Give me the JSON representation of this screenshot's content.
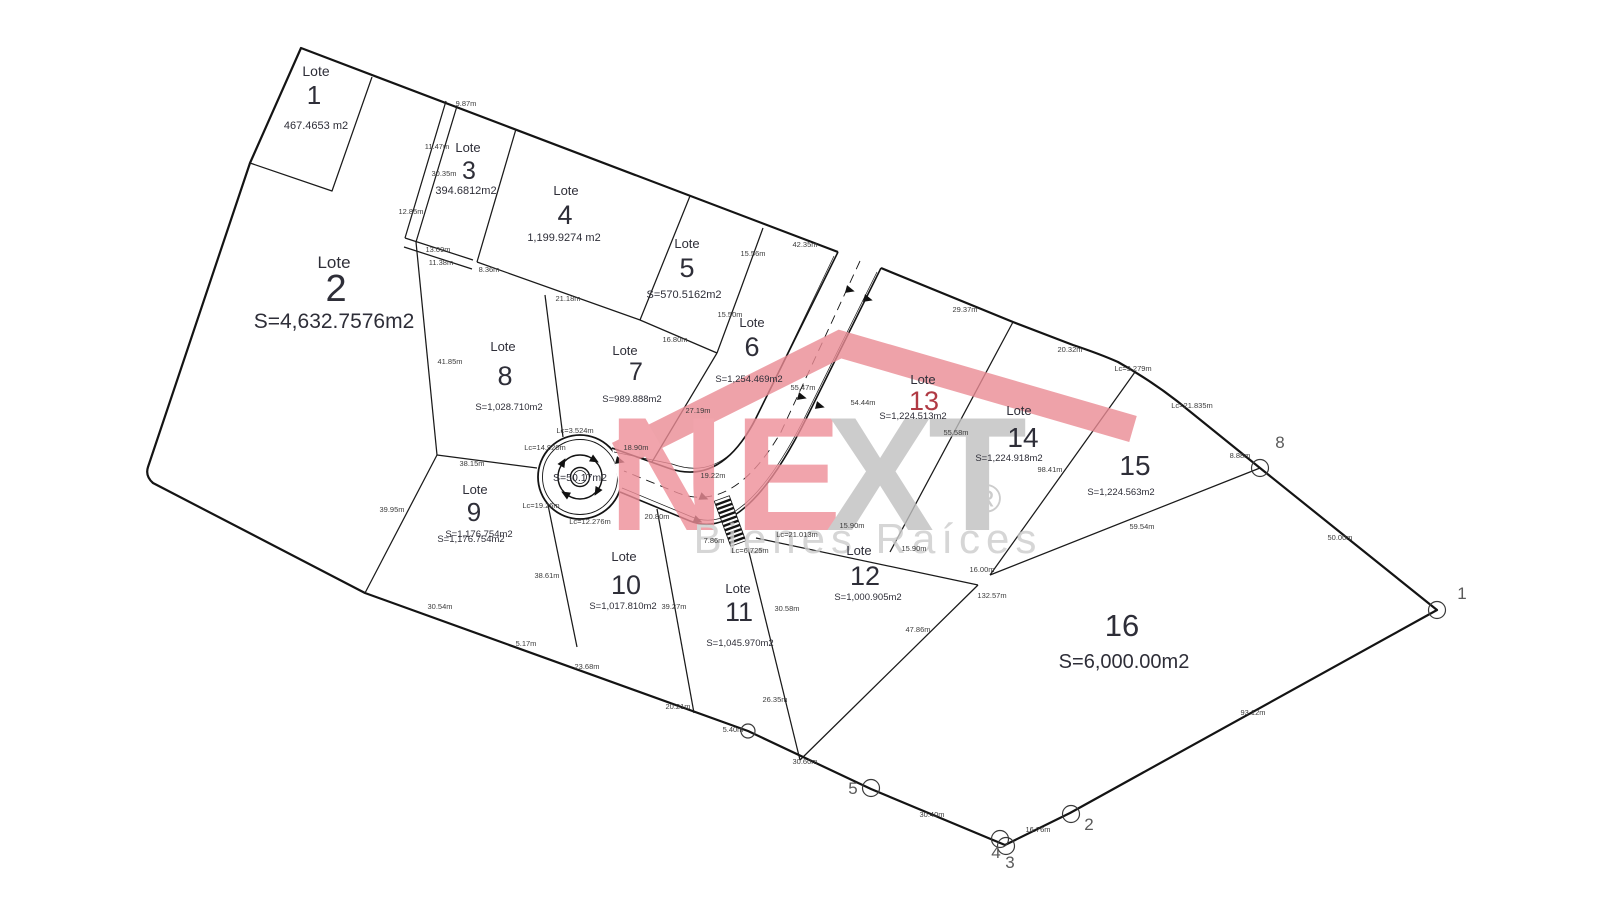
{
  "drawing": {
    "lots": [
      {
        "label": "Lote",
        "number": "1",
        "area": "467.4653 m2"
      },
      {
        "label": "Lote",
        "number": "2",
        "area": "S=4,632.7576m2"
      },
      {
        "label": "Lote",
        "number": "3",
        "area": "394.6812m2"
      },
      {
        "label": "Lote",
        "number": "4",
        "area": "1,199.9274 m2"
      },
      {
        "label": "Lote",
        "number": "5",
        "area": "S=570.5162m2"
      },
      {
        "label": "Lote",
        "number": "6",
        "area": "S=1,254.469m2"
      },
      {
        "label": "Lote",
        "number": "7",
        "area": "S=989.888m2"
      },
      {
        "label": "Lote",
        "number": "8",
        "area": "S=1,028.710m2"
      },
      {
        "label": "Lote",
        "number": "9",
        "area": "S=1,176.754m2"
      },
      {
        "label": "Lote",
        "number": "10",
        "area": "S=1,017.810m2"
      },
      {
        "label": "Lote",
        "number": "11",
        "area": "S=1,045.970m2"
      },
      {
        "label": "Lote",
        "number": "12",
        "area": "S=1,000.905m2"
      },
      {
        "label": "Lote",
        "number": "13",
        "area": "S=1,224.513m2",
        "number_color": "#b03a44"
      },
      {
        "label": "Lote",
        "number": "14",
        "area": "S=1,224.918m2"
      },
      {
        "label": "",
        "number": "15",
        "area": "S=1,224.563m2"
      },
      {
        "label": "",
        "number": "16",
        "area": "S=6,000.00m2"
      }
    ],
    "dimensions": [
      {
        "text": "9.87m"
      },
      {
        "text": "11.47m"
      },
      {
        "text": "30.35m"
      },
      {
        "text": "12.85m"
      },
      {
        "text": "13.09m"
      },
      {
        "text": "11.38m"
      },
      {
        "text": "8.36m"
      },
      {
        "text": "21.18m"
      },
      {
        "text": "41.85m"
      },
      {
        "text": "15.56m"
      },
      {
        "text": "15.50m"
      },
      {
        "text": "16.80m"
      },
      {
        "text": "27.19m"
      },
      {
        "text": "42.35m"
      },
      {
        "text": "29.37m"
      },
      {
        "text": "20.32m"
      },
      {
        "text": "Lc=9.279m"
      },
      {
        "text": "Lc=21.835m"
      },
      {
        "text": "8.88m"
      },
      {
        "text": "50.00m"
      },
      {
        "text": "93.12m"
      },
      {
        "text": "16.76m"
      },
      {
        "text": "30.40m"
      },
      {
        "text": "30.60m"
      },
      {
        "text": "5.40m"
      },
      {
        "text": "20.21m"
      },
      {
        "text": "23.68m"
      },
      {
        "text": "5.17m"
      },
      {
        "text": "30.54m"
      },
      {
        "text": "39.95m"
      },
      {
        "text": "38.15m"
      },
      {
        "text": "38.61m"
      },
      {
        "text": "39.27m"
      },
      {
        "text": "30.58m"
      },
      {
        "text": "26.35m"
      },
      {
        "text": "47.86m"
      },
      {
        "text": "15.90m"
      },
      {
        "text": "15.90m"
      },
      {
        "text": "16.00m"
      },
      {
        "text": "132.57m"
      },
      {
        "text": "55.58m"
      },
      {
        "text": "98.41m"
      },
      {
        "text": "59.54m"
      },
      {
        "text": "55.47m"
      },
      {
        "text": "54.44m"
      },
      {
        "text": "18.90m"
      },
      {
        "text": "19.22m"
      },
      {
        "text": "20.80m"
      },
      {
        "text": "7.86m"
      },
      {
        "text": "Lc=6.725m"
      },
      {
        "text": "Lc=21.013m"
      },
      {
        "text": "Lc=3.524m"
      },
      {
        "text": "Lc=14.920m"
      },
      {
        "text": "Lc=19.26m"
      },
      {
        "text": "Lc=12.276m"
      }
    ],
    "points": [
      {
        "label": "8"
      },
      {
        "label": "1"
      },
      {
        "label": "2"
      },
      {
        "label": "3"
      },
      {
        "label": "4"
      },
      {
        "label": "5"
      }
    ],
    "roundabout_area": "S=50.17m2",
    "watermark": {
      "brand_letters": [
        {
          "ch": "N",
          "color": "#ee8e98"
        },
        {
          "ch": "E",
          "color": "#ee8e98"
        },
        {
          "ch": "X",
          "color": "#c0c0c0"
        },
        {
          "ch": "T",
          "color": "#c0c0c0"
        }
      ],
      "registered": "®",
      "tagline": "Bienes Raíces",
      "roof_color": "#ea8b94"
    }
  }
}
